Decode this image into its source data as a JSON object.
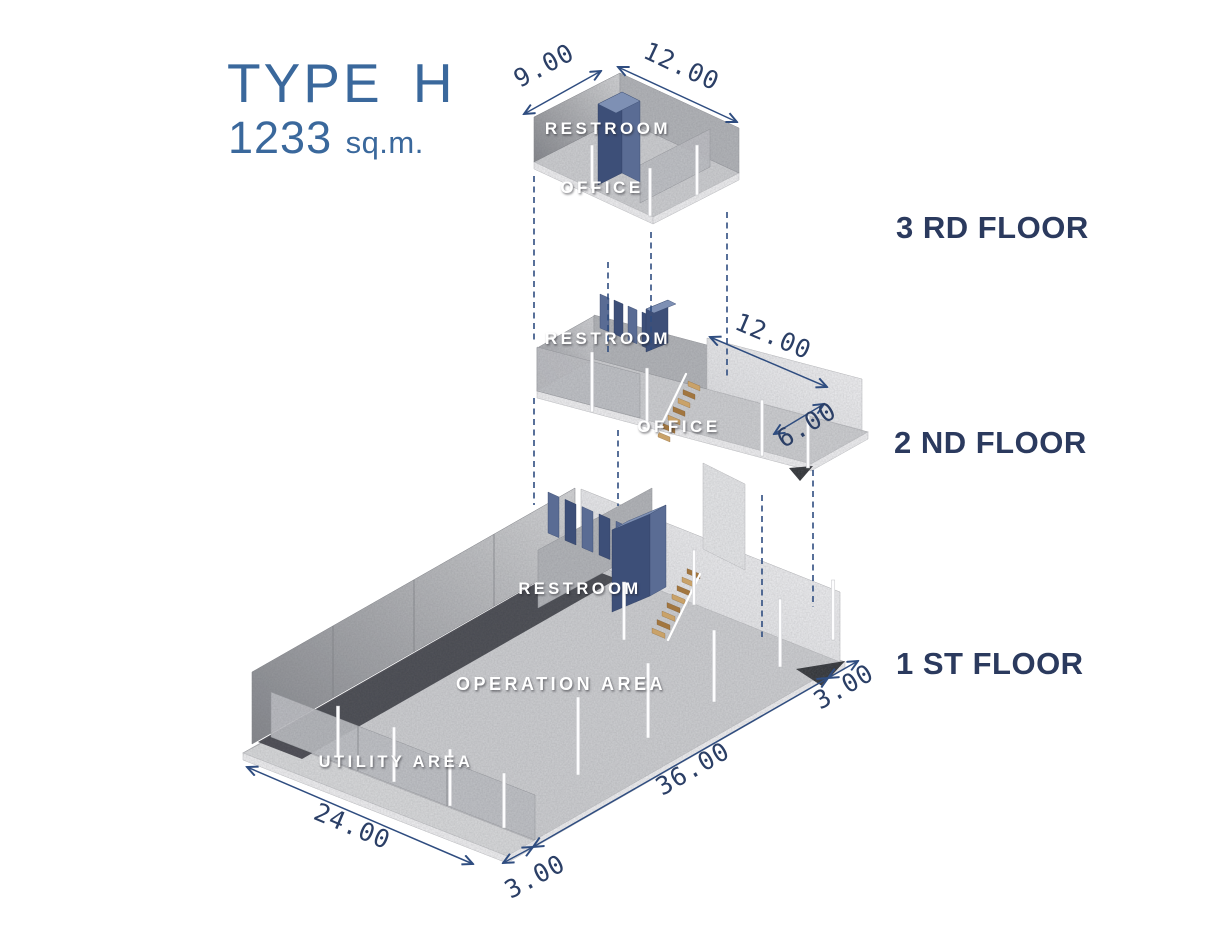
{
  "title": {
    "heading": "TYPE H",
    "area_value": "1233",
    "area_unit": "sq.m."
  },
  "floors": {
    "f3": {
      "label": "3 RD FLOOR",
      "rooms": {
        "restroom": "RESTROOM",
        "office": "OFFICE"
      },
      "dims": {
        "width": "9.00",
        "length": "12.00"
      }
    },
    "f2": {
      "label": "2 ND FLOOR",
      "rooms": {
        "restroom": "RESTROOM",
        "office": "OFFICE"
      },
      "dims": {
        "office_length": "12.00",
        "office_width": "6.00"
      }
    },
    "f1": {
      "label": "1 ST FLOOR",
      "rooms": {
        "restroom": "RESTROOM",
        "operation_area": "OPERATION AREA",
        "utility_area": "UTILITY AREA"
      },
      "dims": {
        "width": "24.00",
        "front_margin": "3.00",
        "length": "36.00",
        "side_margin": "3.00"
      }
    }
  },
  "colors": {
    "background": "#ffffff",
    "title_blue": "#3a689c",
    "label_navy": "#2b3a5e",
    "dim_blue": "#2f4d80",
    "dim_text": "#2b3f66",
    "room_text": "#ffffff",
    "restroom_dark": "#3d4f78",
    "restroom_mid": "#5a6c94",
    "restroom_light": "#7e90b4",
    "wood_light": "#c9a269",
    "wood_dark": "#a2763f",
    "concrete_floor": "#cfd0d3",
    "concrete_wall": "#b4b6ba",
    "shadow_dark": "#3c3e44"
  }
}
